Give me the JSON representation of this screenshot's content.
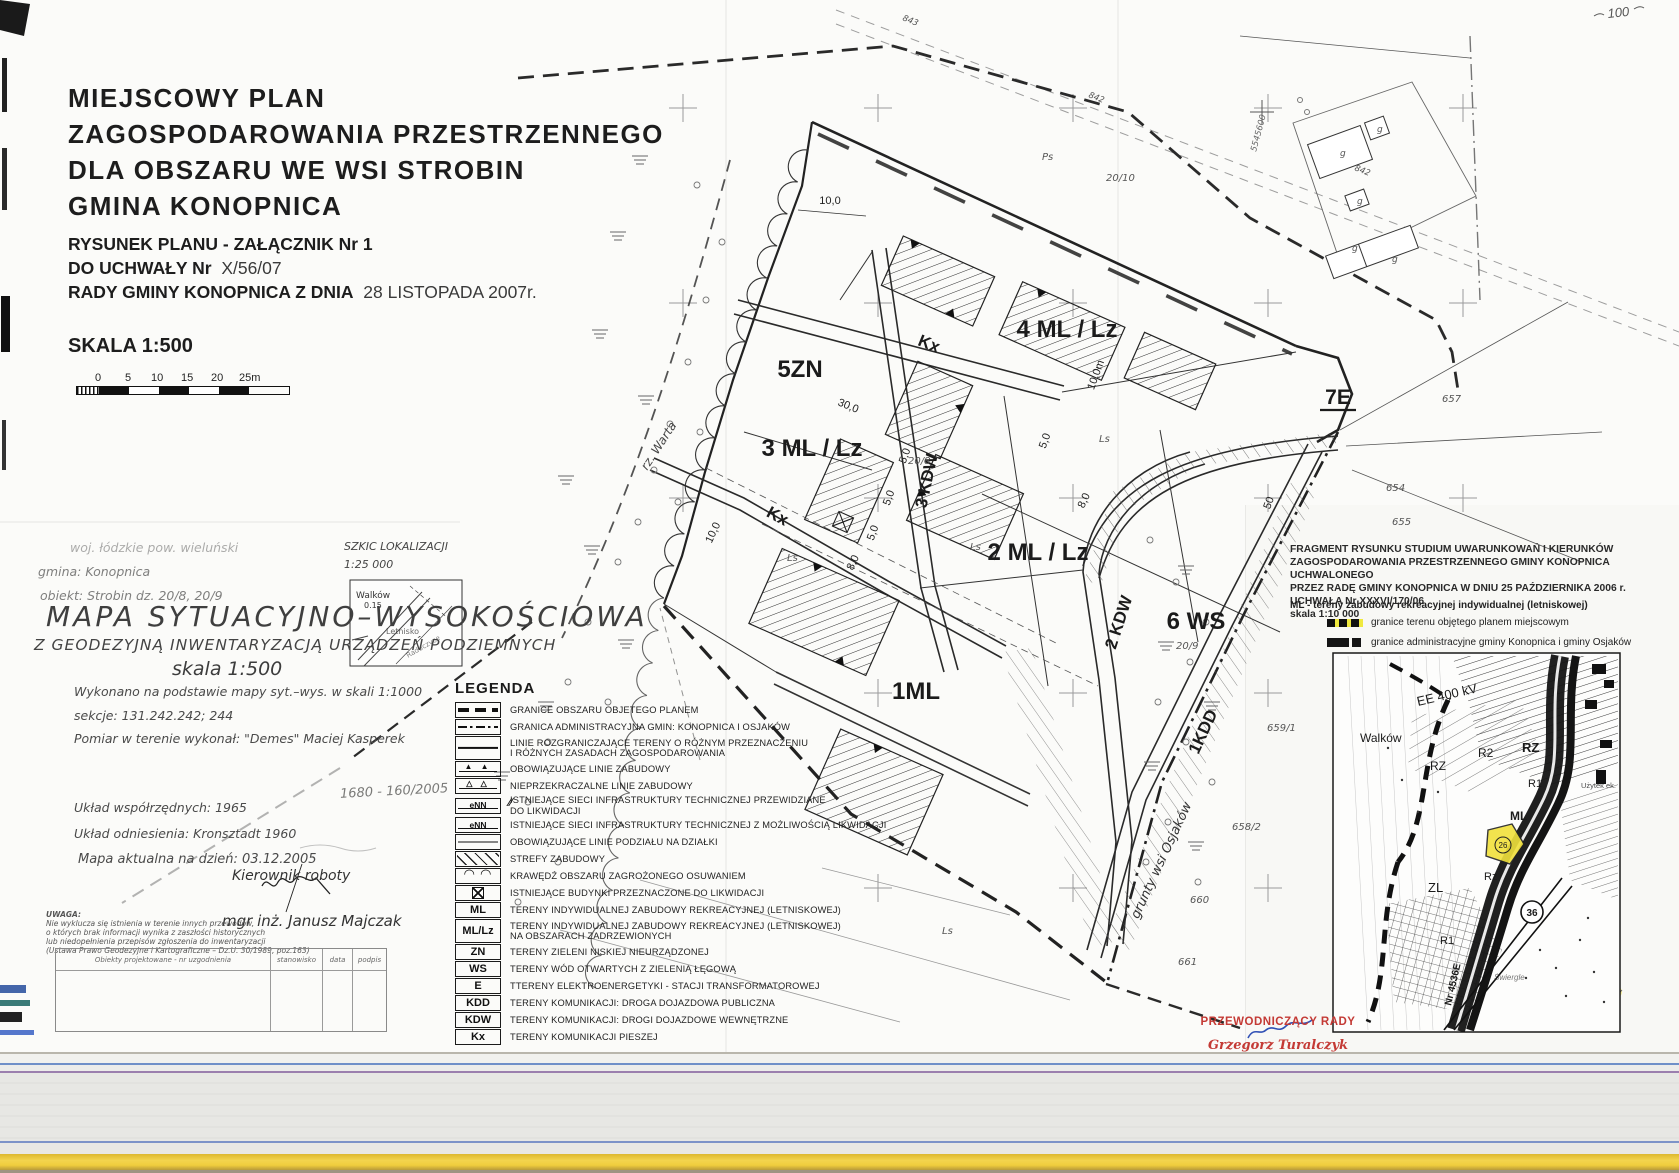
{
  "header": {
    "title_lines": [
      "MIEJSCOWY  PLAN",
      "ZAGOSPODAROWANIA  PRZESTRZENNEGO",
      "DLA  OBSZARU  WE WSI  STROBIN",
      "GMINA  KONOPNICA"
    ],
    "attachment_line": "RYSUNEK PLANU - ZAŁĄCZNIK Nr 1",
    "resolution_label": "DO UCHWAŁY  Nr",
    "resolution_value": "X/56/07",
    "council_label": "RADY GMINY KONOPNICA Z DNIA",
    "council_value": "28 LISTOPADA 2007r.",
    "scale_label": "SKALA 1:500",
    "scalebar_ticks": [
      "0",
      "5",
      "10",
      "15",
      "20",
      "25m"
    ]
  },
  "survey": {
    "voivodeship_line": "woj. łódzkie   pow. wieluński",
    "commune_line": "gmina: Konopnica",
    "object_line": "obiekt: Strobin   dz. 20/8, 20/9",
    "title": "MAPA SYTUACYJNO–WYSOKOŚCIOWA",
    "subtitle": "Z GEODEZYJNĄ INWENTARYZACJĄ URZĄDZEŃ PODZIEMNYCH",
    "scale": "skala 1:500",
    "basis_line": "Wykonano na podstawie mapy syt.–wys. w skali 1:1000",
    "sections_line": "sekcje: 131.242.242; 244",
    "fieldwork_line": "Pomiar w terenie wykonał: \"Demes\" Maciej Kasperek",
    "coord_system_line": "Układ współrzędnych: 1965",
    "datum_line": "Układ odniesienia: Kronsztadt 1960",
    "currency_line": "Mapa aktualna na dzień: 03.12.2005",
    "manager_label": "Kierownik roboty",
    "manager_name": "mgr inż. Janusz Majczak",
    "note_title": "UWAGA:",
    "note_lines": [
      "Nie wyklucza się istnienia w terenie innych przewodów,",
      "o których brak informacji wynika z zaszłości historycznych",
      "lub niedopełnienia przepisów zgłoszenia do inwentaryzacji",
      "(Ustawa Prawo Geodezyjne i Kartograficzne – Dz.U. 30/1989, poz.163)"
    ],
    "table_headers": [
      "Obiekty projektowane - nr uzgodnienia",
      "stanowisko",
      "data",
      "podpis"
    ],
    "handwritten_ref": "1680 - 160/2005"
  },
  "sketch": {
    "title": "SZKIC LOKALIZACJI",
    "scale": "1:25 000",
    "labels": {
      "walkow": "Walków",
      "height": "0.15",
      "letnisko": "Letnisko",
      "village": "Raduczyce"
    }
  },
  "legend": {
    "title": "LEGENDA",
    "items": [
      {
        "label": "GRANICE OBSZARU OBJETEGO PLANEM"
      },
      {
        "label": "GRANICA ADMINISTRACYJNA GMIN: KONOPNICA I OSJAKÓW"
      },
      {
        "label": "LINIE ROZGRANICZAJĄCE TERENY O RÓŻNYM PRZEZNACZENIU\nI RÓŻNYCH ZASADACH ZAGOSPODAROWANIA"
      },
      {
        "label": "OBOWIĄZUJĄCE LINIE ZABUDOWY"
      },
      {
        "label": "NIEPRZEKRACZALNE LINIE ZABUDOWY"
      },
      {
        "code": "eNN",
        "label": "ISTNIEJĄCE SIECI INFRASTRUKTURY TECHNICZNEJ PRZEWIDZIANE\nDO LIKWIDACJI"
      },
      {
        "code": "eNN",
        "label": "ISTNIEJĄCE SIECI INFRASTRUKTURY TECHNICZNEJ Z MOŻLIWOŚCIĄ  LIKWIDACJI"
      },
      {
        "label": "OBOWIĄZUJĄCE LINIE PODZIAŁU NA DZIAŁKI"
      },
      {
        "label": "STREFY ZABUDOWY"
      },
      {
        "label": "KRAWĘDŹ OBSZARU ZAGROŻONEGO OSUWANIEM"
      },
      {
        "label": "ISTNIEJĄCE BUDYNKI PRZEZNACZONE DO LIKWIDACJI"
      },
      {
        "code": "ML",
        "label": "TERENY INDYWIDUALNEJ ZABUDOWY REKREACYJNEJ (LETNISKOWEJ)"
      },
      {
        "code": "ML/Lz",
        "label": "TERENY INDYWIDUALNEJ ZABUDOWY REKREACYJNEJ (LETNISKOWEJ)\nNA OBSZARACH  ZADRZEWIONYCH"
      },
      {
        "code": "ZN",
        "label": "TERENY ZIELENI NISKIEJ NIEURZĄDZONEJ"
      },
      {
        "code": "WS",
        "label": "TERENY WÓD OTWARTYCH Z ZIELENIĄ ŁĘGOWĄ"
      },
      {
        "code": "E",
        "label": "TTERENY ELEKTROENERGETYKI - STACJI TRANSFORMATOROWEJ"
      },
      {
        "code": "KDD",
        "label": "TERENY KOMUNIKACJI: DROGA DOJAZDOWA PUBLICZNA"
      },
      {
        "code": "KDW",
        "label": "TERENY KOMUNIKACJI: DROGI DOJAZDOWE WEWNĘTRZNE"
      },
      {
        "code": "Kx",
        "label": "TERENY KOMUNIKACJI PIESZEJ"
      }
    ]
  },
  "map": {
    "zones": {
      "z5": "5ZN",
      "z3": "3 ML / Lz",
      "z4": "4 ML / Lz",
      "z2": "2 ML / Lz",
      "z1": "1ML",
      "z6": "6 WS",
      "z7": "7E"
    },
    "roads": {
      "kx_upper": "Kx",
      "kx_lower": "Kx",
      "kdw3": "3 KDW",
      "kdw2": "2 KDW",
      "kdd1": "1KDD"
    },
    "dims": {
      "d1": "10,0",
      "d2": "30,0",
      "d3": "10,0m",
      "d4": "5,0",
      "d5": "5,0",
      "d6": "5,0",
      "d7": "5,0",
      "d8": "50",
      "d9": "8,0",
      "d10": "10,0",
      "d11": "8,0"
    },
    "parcels": {
      "p1": "Ps",
      "p2": "20/10",
      "p3": "20/8",
      "p4": "20/9",
      "p5": "654",
      "p6": "655",
      "p7": "657",
      "p8": "659/1",
      "p9": "658/2",
      "p10": "660",
      "p11": "661",
      "p12": "843",
      "p13": "842",
      "p14": "842",
      "p15": "Ls",
      "p16": "Ls",
      "p17": "Ls",
      "p18": "Ls"
    },
    "river_label": "rz. Warta",
    "osjakow_label": "grunty wsi Osjaków",
    "building_letter": "g",
    "coord_label": "5545600",
    "handwriting_top_right": "100"
  },
  "studium": {
    "heading_lines": [
      "FRAGMENT RYSUNKU STUDIUM UWARUNKOWAŃ I KIERUNKÓW",
      "ZAGOSPODAROWANIA PRZESTRZENNEGO GMINY KONOPNICA UCHWALONEGO",
      "PRZEZ RADĘ GMINY KONOPNICA W DNIU 25 PAŹDZIERNIKA 2006 r.",
      "UCHWAŁA Nr XXXVI/170/06",
      "skala 1:10 000"
    ],
    "ml_line": "ML -  tereny zabudowy rekreacyjnej indywidualnej (letniskowej)",
    "legend_plan": "granice terenu objętego planem miejscowym",
    "legend_admin": "granice administracyjne gminy Konopnica i gminy Osjaków",
    "inset_labels": {
      "ee": "EE 400 kV",
      "walkow": "Walków",
      "rz1": "RZ",
      "r2": "R2",
      "rz2": "RZ",
      "r1a": "R1",
      "ml": "ML",
      "rzl": "Rz",
      "zl": "ZL",
      "r1b": "R1",
      "road_no": "36",
      "road_name": "Nr 4536E",
      "parcel": "26",
      "swiergle": "Świergle",
      "uzytek": "Użytek ek."
    }
  },
  "stamp": {
    "title": "PRZEWODNICZĄCY RADY",
    "name": "Grzegorz Turalczyk"
  }
}
